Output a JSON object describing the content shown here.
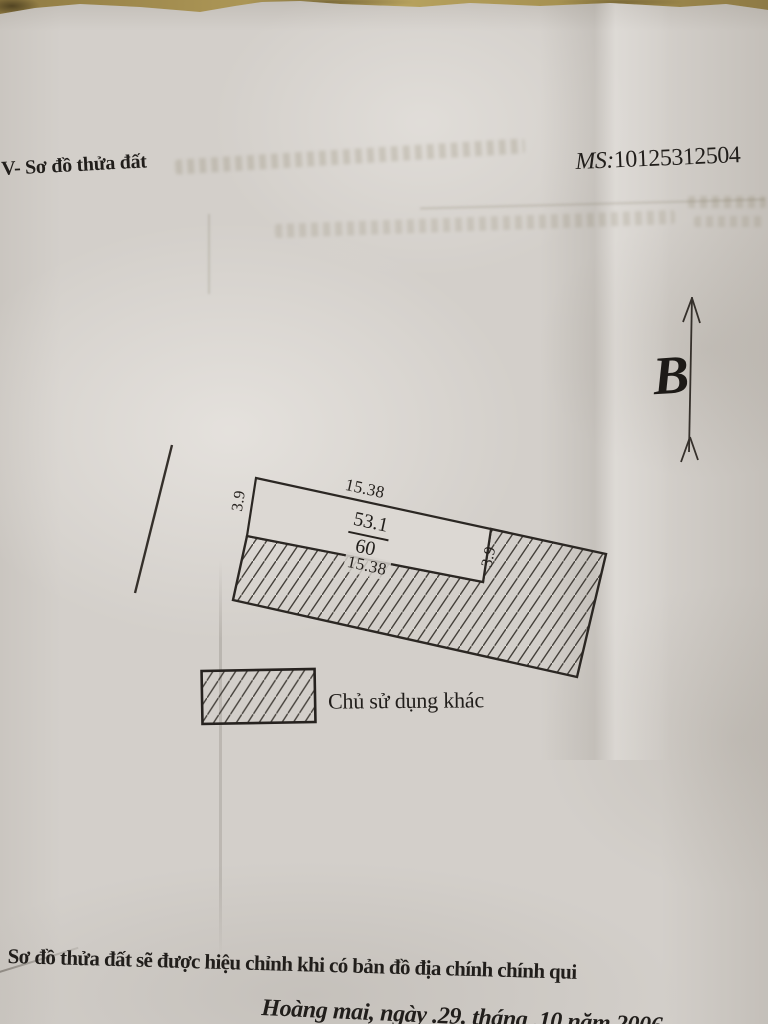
{
  "document": {
    "section_title": "V- Sơ đồ thửa đất",
    "ms_label": "MS:",
    "ms_number": "10125312504"
  },
  "compass": {
    "north_label": "B"
  },
  "parcel": {
    "top_length": "15.38",
    "bottom_length": "15.38",
    "left_width": "3.9",
    "right_width": "3.9",
    "parcel_number": "53.1",
    "area": "60"
  },
  "legend": {
    "other_user_label": "Chủ sử dụng khác"
  },
  "footer": {
    "revision_note": "Sơ đồ thửa đất sẽ được hiệu chỉnh khi có bản đồ địa chính chính qui",
    "place_date_line": "Hoàng mai, ngày .29. tháng .10 năm 2006"
  },
  "colors": {
    "ink": "#211e1b",
    "paper": "#d3cfca",
    "desk": "#a98f54"
  }
}
